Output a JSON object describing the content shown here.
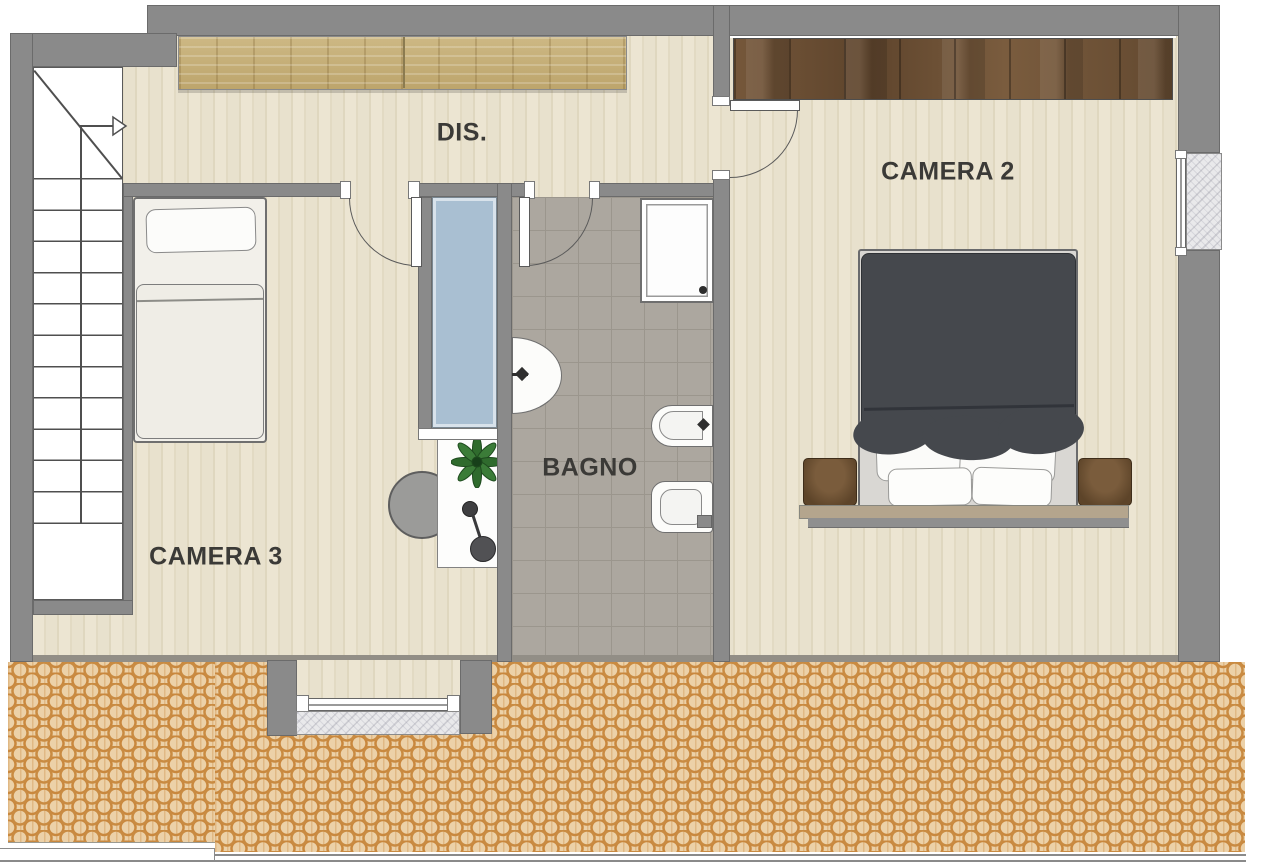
{
  "floorplan": {
    "type": "residential-floor-plan",
    "rooms": {
      "dis": {
        "label": "DIS."
      },
      "camera2": {
        "label": "CAMERA 2"
      },
      "camera3": {
        "label": "CAMERA 3"
      },
      "bagno": {
        "label": "BAGNO"
      }
    },
    "features": [
      "staircase-with-up-arrow",
      "wardrobe-dis",
      "wardrobe-camera2",
      "single-bed",
      "double-bed",
      "nightstands",
      "bench-shelf",
      "desk",
      "plant",
      "stool",
      "pouf",
      "shower-box",
      "glass-niche",
      "washbasin",
      "bidet",
      "toilet",
      "window-right",
      "window-south",
      "roof-terrace"
    ],
    "colors": {
      "wall": "#8a8a8a",
      "floor_wood": "#eae3d0",
      "bath_tile": "#aca79f",
      "roof_tile_base": "#ecd1a8",
      "roof_tile_arc": "#c98b42",
      "glass_blue": "#a9bfd2",
      "wood_light": "#c6b07a",
      "wood_dark": "#6a4e33",
      "duvet": "#45484d",
      "marble": "#e9e9eb",
      "label_text": "#3b3a37"
    }
  }
}
